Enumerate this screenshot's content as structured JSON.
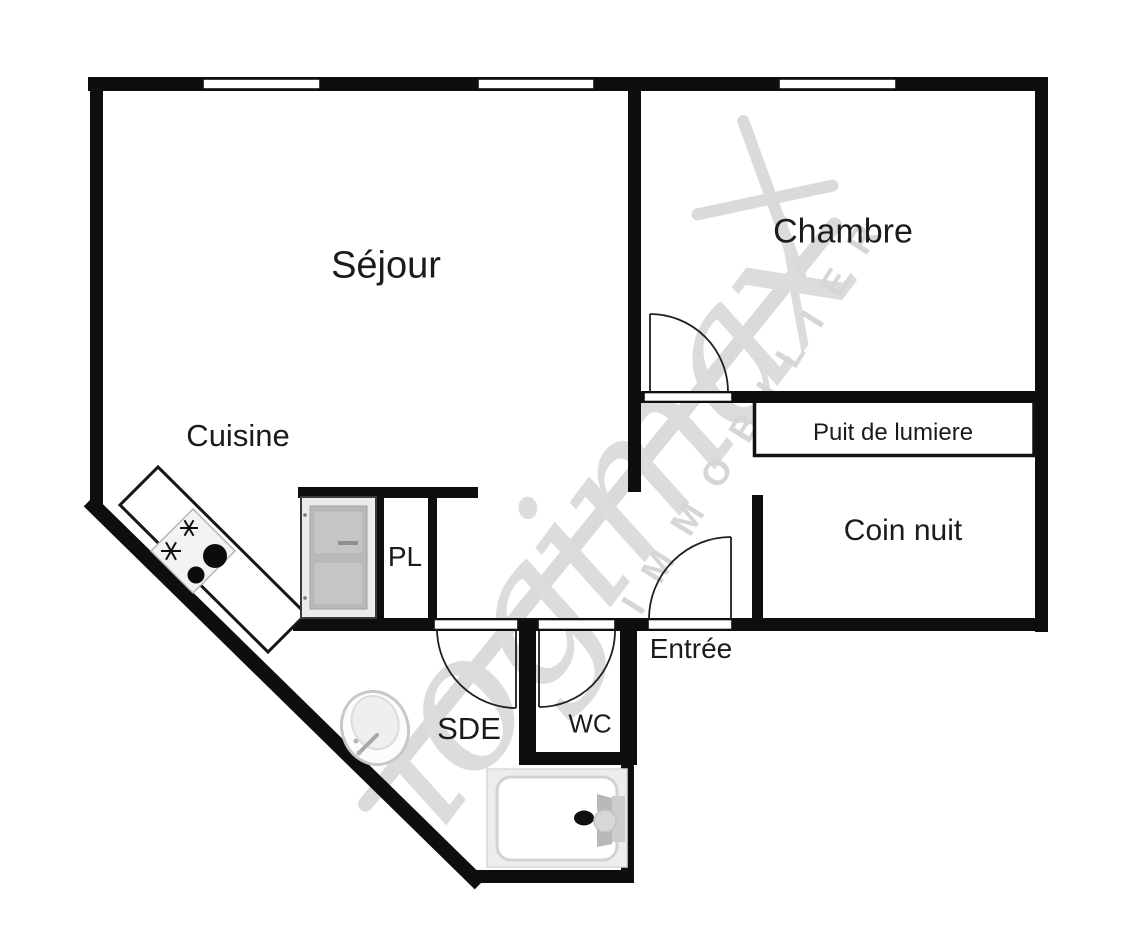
{
  "watermark": {
    "brand": "logimax",
    "tagline": "IMMOBILIER"
  },
  "rooms": {
    "sejour": "Séjour",
    "chambre": "Chambre",
    "cuisine": "Cuisine",
    "puit_de_lumiere": "Puit de lumiere",
    "coin_nuit": "Coin nuit",
    "placard": "PL",
    "entree": "Entrée",
    "sde": "SDE",
    "wc": "WC"
  },
  "icons": {
    "cooktop": "cooktop-burners-icon",
    "sink": "washbasin-icon",
    "bathtub": "bathtub-icon",
    "doors": "door-swing-arc-icon",
    "windows": "window-opening-icon",
    "closet_door": "closet-door-icon"
  },
  "colors": {
    "background": "#ffffff",
    "wall": "#0e0e0e",
    "label_text": "#1b1b1b",
    "watermark_gray": "#dcdcdc",
    "door_panel_gray": "#b9b9b9",
    "fixture_gray": "#ededed"
  }
}
